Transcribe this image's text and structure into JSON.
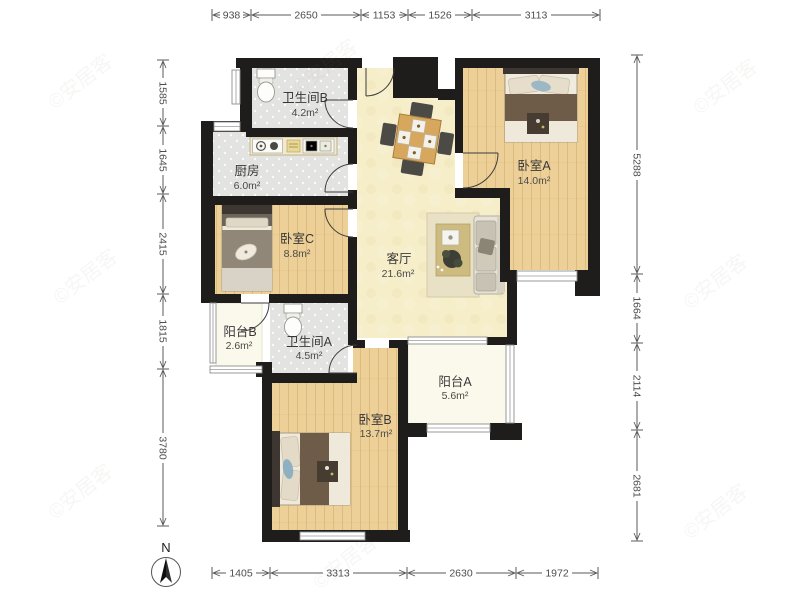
{
  "plan": {
    "rooms": [
      {
        "id": "bathroom-b",
        "name": "卫生间B",
        "area": "4.2m²"
      },
      {
        "id": "kitchen",
        "name": "厨房",
        "area": "6.0m²"
      },
      {
        "id": "bedroom-a",
        "name": "卧室A",
        "area": "14.0m²"
      },
      {
        "id": "bedroom-c",
        "name": "卧室C",
        "area": "8.8m²"
      },
      {
        "id": "living",
        "name": "客厅",
        "area": "21.6m²"
      },
      {
        "id": "balcony-b",
        "name": "阳台B",
        "area": "2.6m²"
      },
      {
        "id": "bathroom-a",
        "name": "卫生间A",
        "area": "4.5m²"
      },
      {
        "id": "balcony-a",
        "name": "阳台A",
        "area": "5.6m²"
      },
      {
        "id": "bedroom-b",
        "name": "卧室B",
        "area": "13.7m²"
      }
    ],
    "dimensions": {
      "top": [
        "938",
        "2650",
        "1153",
        "1526",
        "3113"
      ],
      "left": [
        "1585",
        "1645",
        "2415",
        "1815",
        "3780"
      ],
      "right": [
        "5288",
        "1664",
        "2114",
        "2681"
      ],
      "bottom": [
        "1405",
        "3313",
        "2630",
        "1972"
      ]
    },
    "compass": {
      "label": "N"
    },
    "watermark": "©安居客",
    "colors": {
      "wall": "#1e1d1b",
      "wood_floor": "#edd098",
      "tile_floor": "#e4e4e2",
      "living_floor": "#f6edc9",
      "balcony_floor": "#fbf8ec",
      "bed_blanket": "#6f5c48",
      "dim_text": "#4d4d4d"
    }
  }
}
